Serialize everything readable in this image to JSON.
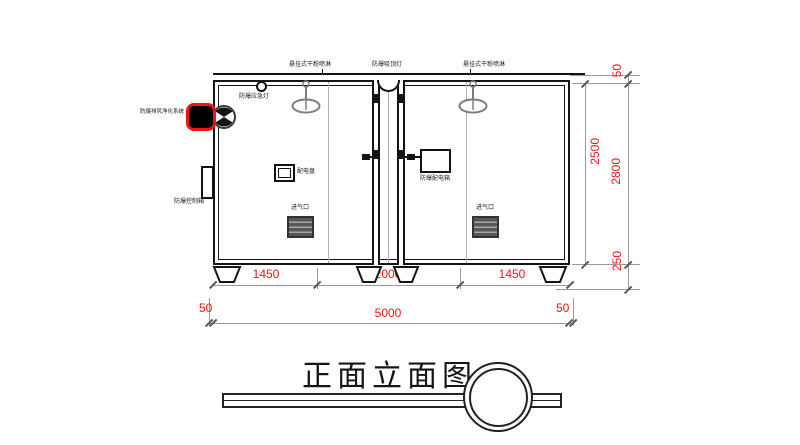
{
  "drawing": {
    "title": "正面立面图"
  },
  "labels": {
    "sprinkler_left": "悬挂式干粉喷淋",
    "ceiling_light": "防爆吸顶灯",
    "sprinkler_right": "悬挂式干粉喷淋",
    "emergency_light": "防爆应急灯",
    "exhaust_purifier": "防爆排风净化系统",
    "control_box": "防爆控制箱",
    "power_panel": "配电盘",
    "distribution_box": "防爆配电箱",
    "air_inlet_left": "进气口",
    "air_inlet_right": "进气口"
  },
  "dims": {
    "right_top": "50",
    "right_inner": "2500",
    "right_overall": "2800",
    "right_base": "250",
    "seg_left": "1450",
    "seg_center": "2000",
    "seg_right": "1450",
    "margin_left": "50",
    "overall_width": "5000",
    "margin_right": "50"
  },
  "colors": {
    "dimension_red": "#f21313",
    "line_black": "#141414",
    "fixture_gray": "#7d7d7d"
  }
}
